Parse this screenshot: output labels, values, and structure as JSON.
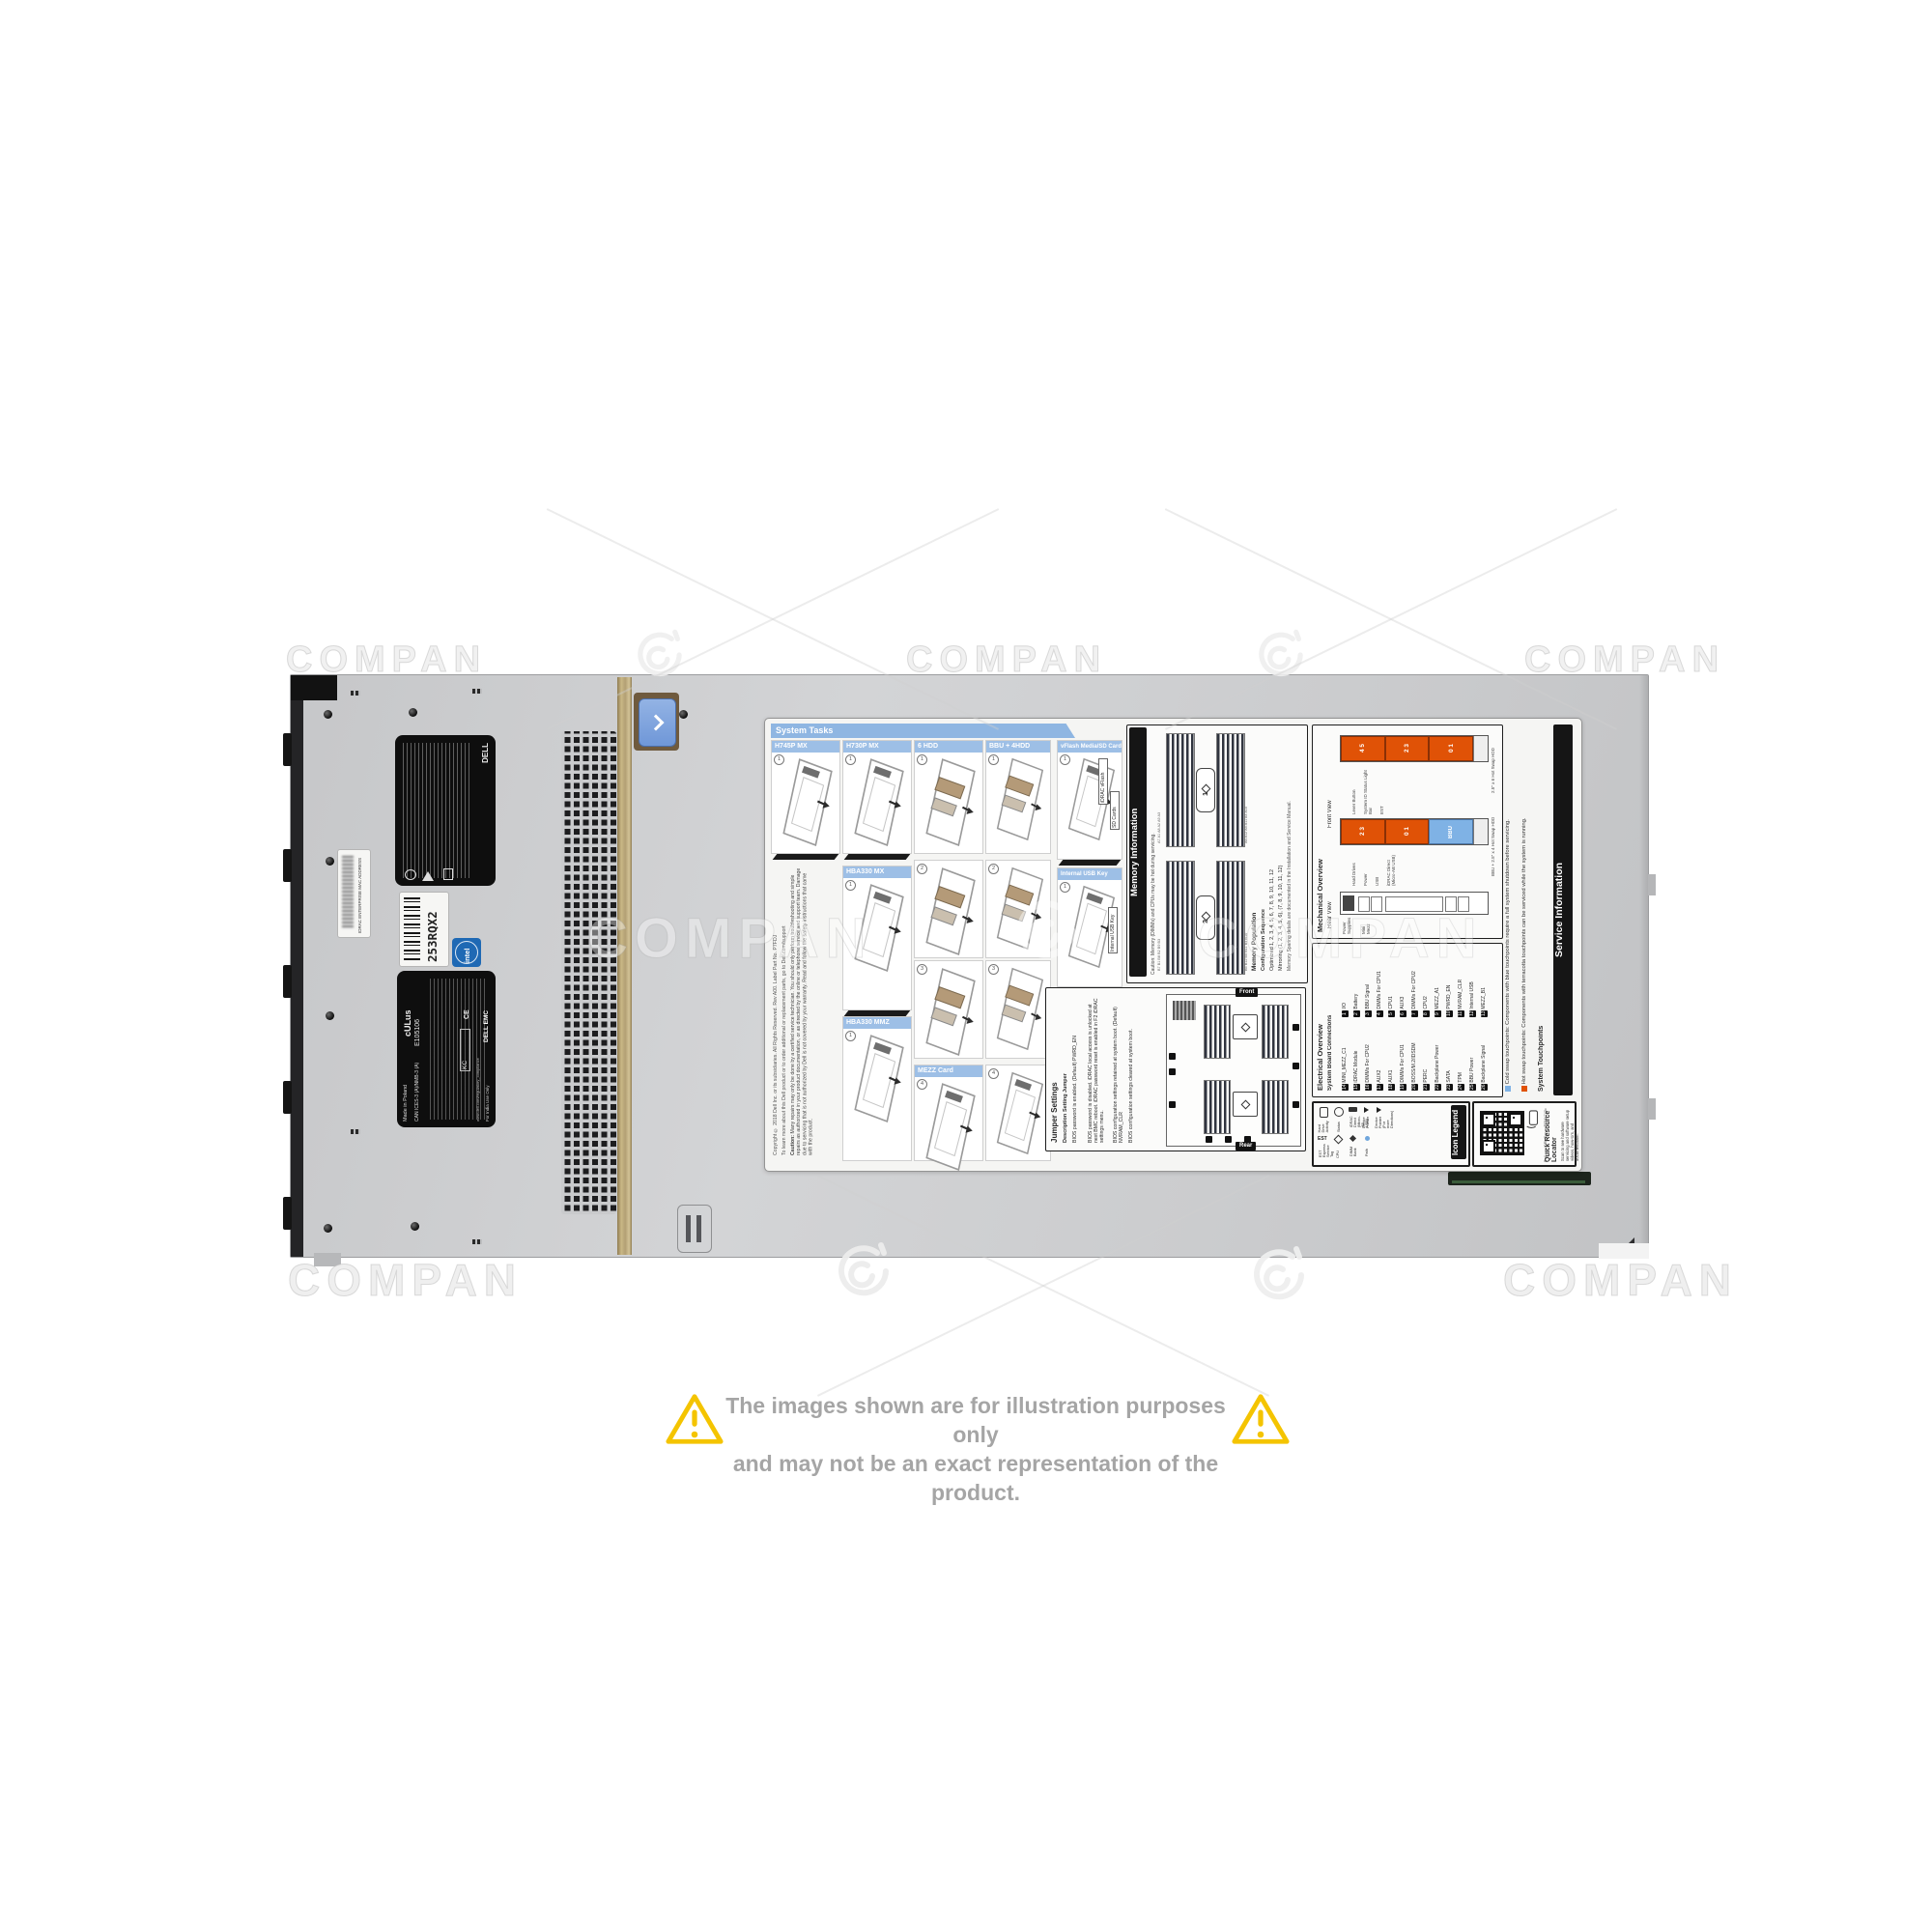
{
  "photo": {
    "watermark_text": "COMPAN",
    "disclaimer": {
      "line1": "The images shown are for illustration purposes only",
      "line2": "and may not be an exact representation of the product."
    }
  },
  "chassis": {
    "stickers": {
      "brand": "DELL",
      "service_tag": "253RQX2",
      "mac_label": "IDRAC ENTERPRISE MAC ADDRESS",
      "intel_logo": "intel",
      "ul_mark": "cULus",
      "ul_file": "E105106",
      "made_in": "Made in Poland",
      "ices": "CAN ICES-3 (A)/NMB-3 (A)",
      "ce_mark": "CE",
      "kc_mark": "KC",
      "dell_emc": "DELL EMC",
      "india_note": "For India Use Only",
      "reg_site": "www.dell.com/regulatory_compliance"
    }
  },
  "label": {
    "system_tasks": {
      "title": "System Tasks",
      "steps": [
        "1",
        "2",
        "3",
        "4"
      ],
      "panels": {
        "h745p": "H745P MX",
        "h730p": "H730P MX",
        "hdd6": "6 HDD",
        "bbu4hdd": "BBU + 4HDD",
        "hba330mx": "HBA330 MX",
        "hba330mmz": "HBA330 MMZ",
        "mezz": "MEZZ Card",
        "vflash": "vFlash Media/SD Card",
        "usbkey": "Internal USB Key"
      },
      "callouts": {
        "idrac_vflash": "iDRAC vFlash",
        "sd_cards": "SD Cards",
        "internal_usb_key": "Internal USB Key"
      },
      "caution_title": "Caution:",
      "caution_text": "Many repairs may only be done by a certified service technician. You should only perform troubleshooting and simple repairs as authorized in your product documentation, or as directed by the online or telephone service and support team. Damage due to servicing that is not authorized by Dell is not covered by your warranty. Read and follow the safety instructions that came with the product.",
      "support_text": "To learn more about this Dell product or to order additional or replacement parts, go to Dell.com/support",
      "copyright_text": "Copyright © 2018 Dell Inc. or its subsidiaries. All Rights Reserved. Rev A00. Label Part No. P7FDJ"
    },
    "memory": {
      "title": "Memory Information",
      "caution": "Caution: Memory (DIMMs) and CPUs may be hot during servicing.",
      "population_title": "Memory Population",
      "col_config": "Configuration",
      "col_sequence": "Sequence",
      "rows": [
        {
          "config": "Optimized",
          "sequence": "1, 2, 3, 4, 5, 6, 7, 8, 9, 10, 11, 12"
        },
        {
          "config": "Mirroring",
          "sequence": "(1, 2, 3, 4, 5, 6), (7, 8, 9, 10, 11, 12)"
        }
      ],
      "sparing_note": "Memory Sparing details are documented in the Installation and Service Manual.",
      "cpu1": "1",
      "cpu2": "2",
      "slots_a_left": "A7 A1 A8 A2 A9 A3",
      "slots_a_right": "A6 A12 A5 A11 A4 A10",
      "slots_b_left": "B7 B1 B8 B2 B9 B3",
      "slots_b_right": "B6 B12 B5 B11 B4 B10"
    },
    "jumpers": {
      "title": "Jumper Settings",
      "col_jumper": "Jumper",
      "col_setting": "Setting",
      "col_description": "Description",
      "pwrd_en": "PWRD_EN",
      "nvram_clr": "NVRAM_CLR",
      "rows": [
        {
          "setting": "(Default)",
          "description": "BIOS password is enabled."
        },
        {
          "setting": " ",
          "description": "BIOS password is disabled. iDRAC local access is unlocked at next BMC reboot. iDRAC password reset is enabled in F2 iDRAC settings menu."
        },
        {
          "setting": "(Default)",
          "description": "BIOS configuration settings retained at system boot."
        },
        {
          "setting": " ",
          "description": "BIOS configuration settings cleared at system boot."
        }
      ],
      "front_tag": "Front",
      "rear_tag": "Rear"
    },
    "service_info": {
      "title": "Service Information",
      "subtitle": "System Touchpoints",
      "hot": "Hot swap touchpoints: Components with terracotta touchpoints can be serviced while the system is running.",
      "cold": "Cold swap touchpoints: Components with blue touchpoints require a full system shutdown before servicing."
    },
    "mechanical": {
      "title": "Mechanical Overview",
      "front_view": "Front View",
      "rear_view": "Rear View",
      "bar1_caption": "2.5\" x 6 Hot Swap HDD",
      "bar2_caption": "BBU + 2.5\" x 4 Hot Swap HDD",
      "bar1_segments": [
        "4 5",
        "2 3",
        "0 1"
      ],
      "bar2_segments": [
        "2 3",
        "0 1",
        "BBU"
      ],
      "callouts": [
        "System ID Status Light Bar",
        "Lever Button",
        "EST",
        "Power",
        "USB",
        "iDRAC Direct (Micro-AB USB)",
        "Hard Drives"
      ],
      "rear_callouts": [
        "Power Supplies",
        "Mini Mezz"
      ]
    },
    "electrical": {
      "title": "Electrical Overview",
      "subtitle": "System Board Connections",
      "items": [
        {
          "n": "1",
          "t": "I/O"
        },
        {
          "n": "2",
          "t": "Battery"
        },
        {
          "n": "3",
          "t": "BBU Signal"
        },
        {
          "n": "4",
          "t": "DIMMs For CPU1"
        },
        {
          "n": "5",
          "t": "CPU1"
        },
        {
          "n": "6",
          "t": "AUX3"
        },
        {
          "n": "7",
          "t": "DIMMs For CPU2"
        },
        {
          "n": "8",
          "t": "CPU2"
        },
        {
          "n": "9",
          "t": "MEZZ_A1"
        },
        {
          "n": "10",
          "t": "PWRD_EN"
        },
        {
          "n": "11",
          "t": "NVRAM_CLR"
        },
        {
          "n": "12",
          "t": "Internal USB"
        },
        {
          "n": "13",
          "t": "MEZZ_B1"
        },
        {
          "n": "14",
          "t": "MINI_MEZZ_C1"
        },
        {
          "n": "15",
          "t": "iDRAC Module"
        },
        {
          "n": "16",
          "t": "DIMMs For CPU2"
        },
        {
          "n": "17",
          "t": "AUX2"
        },
        {
          "n": "18",
          "t": "AUX1"
        },
        {
          "n": "19",
          "t": "DIMMs For CPU1"
        },
        {
          "n": "20",
          "t": "BOSS/M.2/IDSDM"
        },
        {
          "n": "21",
          "t": "PERC"
        },
        {
          "n": "22",
          "t": "Backplane Power"
        },
        {
          "n": "23",
          "t": "SATA"
        },
        {
          "n": "24",
          "t": "TPM"
        },
        {
          "n": "25",
          "t": "BBU Power"
        },
        {
          "n": "26",
          "t": "Backplane Signal"
        }
      ]
    },
    "icon_legend": {
      "title": "Icon Legend",
      "entries": [
        "Hard Drive Activity",
        "Status",
        "iDRAC Direct (Micro-AB USB)",
        "Device Pointer",
        "Device Pointer (For more Directions)",
        "EST Express Service Tag",
        "CPU",
        "DIMM Bank",
        "Path"
      ]
    },
    "qrl": {
      "title": "Quick Resource Locator",
      "scan_text": "Scan to see hardware servicing and software setup videos, how-to's, and documentation.",
      "url": "Dell.com/QRL/Server/PEMX740c"
    }
  },
  "colors": {
    "terracotta": "#E05206",
    "touchpoint_blue": "#7FB2E5",
    "header_blue": "#9DBFE6",
    "warning_yellow": "#F4C400"
  }
}
